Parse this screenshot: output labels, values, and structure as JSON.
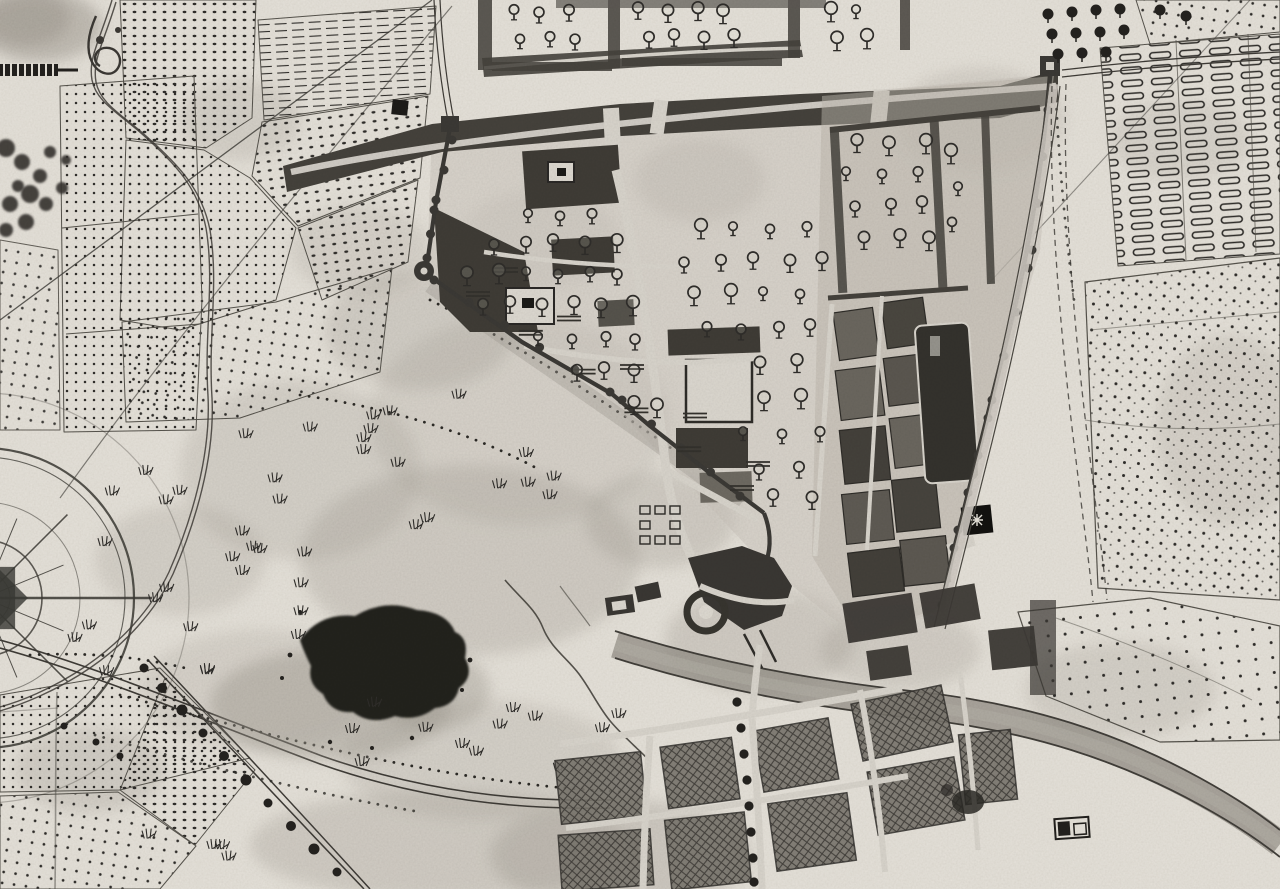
{
  "document": {
    "kind": "historical-manuscript-town-plan",
    "medium": "scanned-ink-drawing",
    "monochrome": true,
    "width_px": 1280,
    "height_px": 889
  },
  "palette": {
    "paper": "#e6e2da",
    "paper_shade": "#cfcac2",
    "stain": "#9d978e",
    "ink": "#2f2d2a",
    "ink_light": "#56534c",
    "wall": "#3b3935",
    "band": "#45423c",
    "block_dark": "#3f3c36",
    "block_gray": "#6b675f",
    "street": "#d9d5cd",
    "road_band": "#8f8a82",
    "blob": "#24221f",
    "halo": "#a09b92"
  },
  "features": {
    "compass_rose": {
      "label": "compass-rose",
      "position": "left-edge-middle"
    },
    "fortified_town": {
      "label": "walled-town-with-bastions",
      "position": "center-right"
    },
    "town_orchards": {
      "label": "garden-plots-with-tree-symbols",
      "position": "town-interior"
    },
    "field_parcels": {
      "label": "stippled-vineyard-parcels",
      "position": "upper-left-and-right"
    },
    "plowed_strips": {
      "label": "hachured-plow-strips",
      "position": "upper-center-left"
    },
    "garden_beds": {
      "label": "garden-bed-strips",
      "position": "upper-right"
    },
    "meadow": {
      "label": "open-meadow-with-grass-tufts",
      "position": "center-left"
    },
    "grove": {
      "label": "dark-tree-grove",
      "position": "center"
    },
    "stream": {
      "label": "meandering-stream",
      "position": "center-south"
    },
    "main_road": {
      "label": "curved-main-road",
      "position": "bottom-left-to-center"
    },
    "tree_avenue": {
      "label": "tree-lined-avenue",
      "position": "bottom-left"
    },
    "river_band": {
      "label": "broad-river-or-highway",
      "position": "bottom-right"
    },
    "suburb": {
      "label": "crosshatched-suburb-blocks",
      "position": "bottom-center"
    },
    "bridge_gate": {
      "label": "bridge-gate-works",
      "position": "south-of-town"
    },
    "scale_bar": {
      "label": "scale-bar-fragment",
      "position": "upper-left-edge"
    },
    "flourish": {
      "label": "scroll-flourish-ornament",
      "position": "top-left"
    },
    "paper_creases": {
      "label": "fold-creases-and-stains",
      "position": "overall"
    }
  }
}
